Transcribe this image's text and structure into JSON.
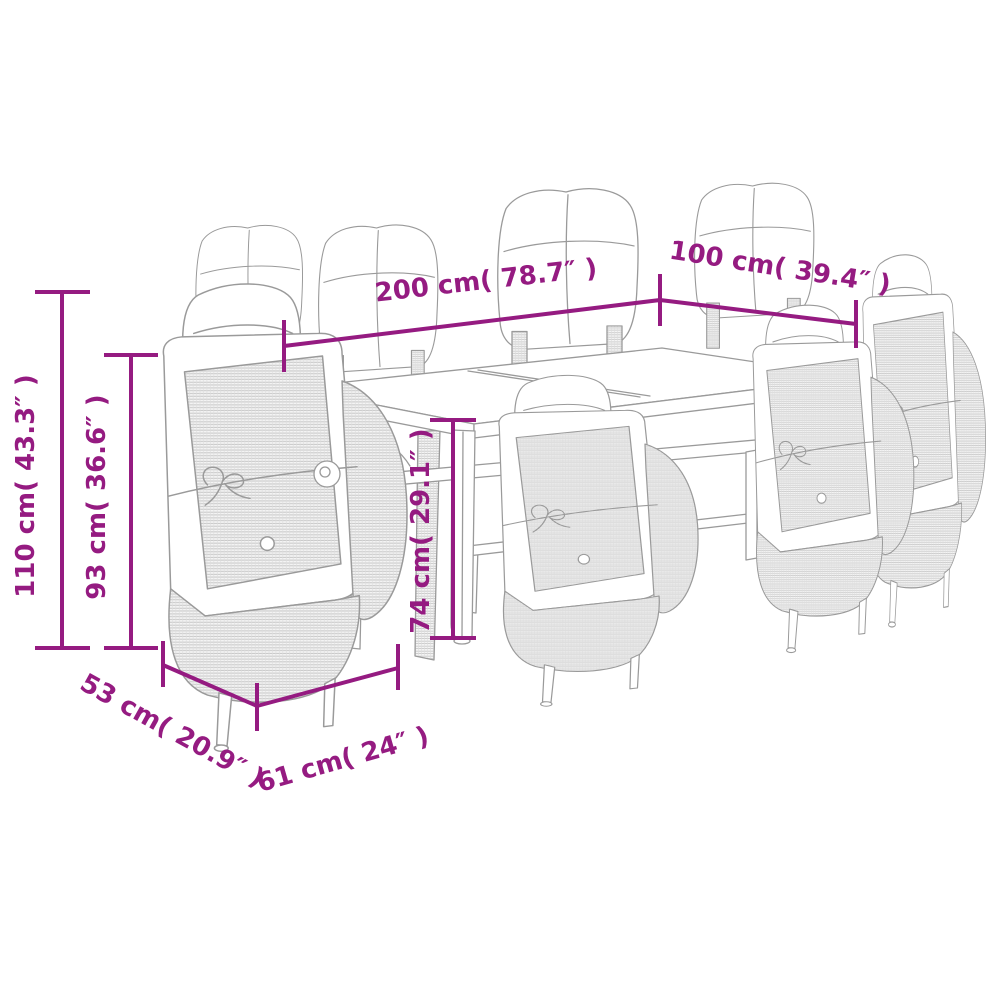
{
  "colors": {
    "dimension": "#951b81",
    "line_art": "#9a9a9a",
    "background": "#ffffff"
  },
  "diagram": {
    "type": "product-dimension-diagram",
    "subject": "outdoor dining set: glass-top table with 8 wicker reclining chairs with cushions"
  },
  "dimensions": {
    "table_length": "200 cm( 78.7″ )",
    "table_width": "100 cm( 39.4″ )",
    "total_height": "110 cm( 43.3″ )",
    "backrest_height": "93 cm( 36.6″ )",
    "table_height": "74 cm( 29.1″ )",
    "chair_depth": "53 cm( 20.9″ )",
    "chair_width": "61 cm( 24″ )"
  }
}
